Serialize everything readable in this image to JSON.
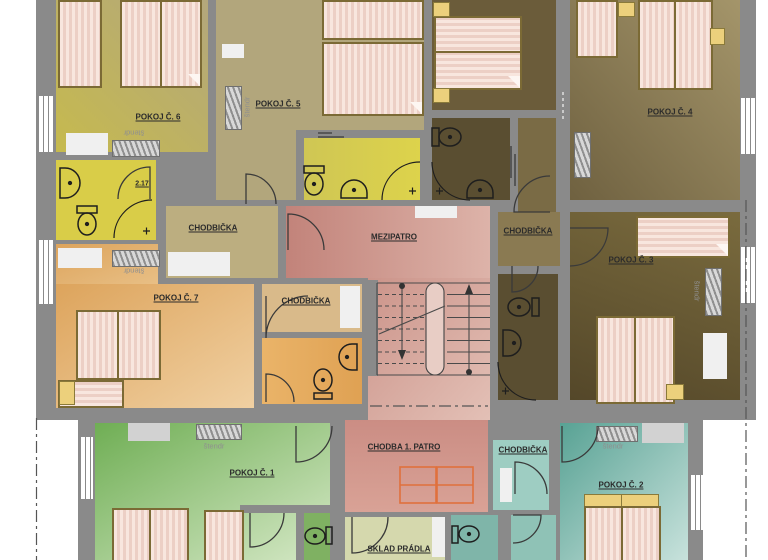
{
  "rooms": {
    "pokoj1": {
      "label": "POKOJ Č. 1"
    },
    "pokoj2": {
      "label": "POKOJ Č. 2"
    },
    "pokoj3": {
      "label": "POKOJ Č. 3"
    },
    "pokoj4": {
      "label": "POKOJ Č. 4"
    },
    "pokoj5": {
      "label": "POKOJ Č. 5"
    },
    "pokoj6": {
      "label": "POKOJ Č. 6"
    },
    "pokoj7": {
      "label": "POKOJ Č. 7"
    },
    "mezipatro": {
      "label": "MEZIPATRO"
    },
    "chodba_1_patro": {
      "label": "CHODBA 1. PATRO"
    },
    "sklad_pradla": {
      "label": "SKLAD PRÁDLA"
    },
    "chodbicka_top_left": {
      "label": "CHODBIČKA"
    },
    "chodbicka_center": {
      "label": "CHODBIČKA"
    },
    "chodbicka_right": {
      "label": "CHODBIČKA"
    },
    "chodbicka_bottom_right": {
      "label": "CHODBIČKA"
    },
    "bathroom_6": {
      "number": "2.17"
    }
  },
  "annotations": {
    "clothes_rack": "štendr"
  },
  "colors": {
    "wall": "#8a8a8a",
    "bathroom_yellow": "#d9cd48",
    "room_tan": "#b2a67c",
    "room_olive": "#c6ba4e",
    "room_brown_light": "#a4956a",
    "room_brown_dark": "#584b2e",
    "room_orange": "#dda45c",
    "hall_pink": "#cc948a",
    "room_green": "#6fae54",
    "room_teal": "#58a294",
    "sklad_sage": "#d5d8ad",
    "bed_fill": "#f8e6de",
    "bed_stripe": "#eccfc5",
    "skylight_accent": "#e0703c"
  }
}
